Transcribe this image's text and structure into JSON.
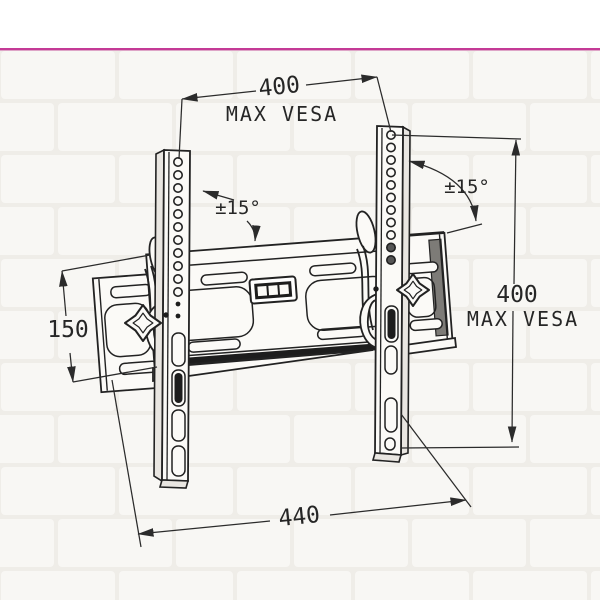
{
  "colors": {
    "top_line": "#c43a96",
    "ink": "#222222",
    "wall": "#f0eee9"
  },
  "annotations": {
    "top_dim_value": "400",
    "top_dim_label": "MAX VESA",
    "right_dim_value": "400",
    "right_dim_label": "MAX VESA",
    "left_dim_value": "150",
    "bottom_dim_value": "440",
    "tilt_left": "±15°",
    "tilt_right": "±15°"
  }
}
